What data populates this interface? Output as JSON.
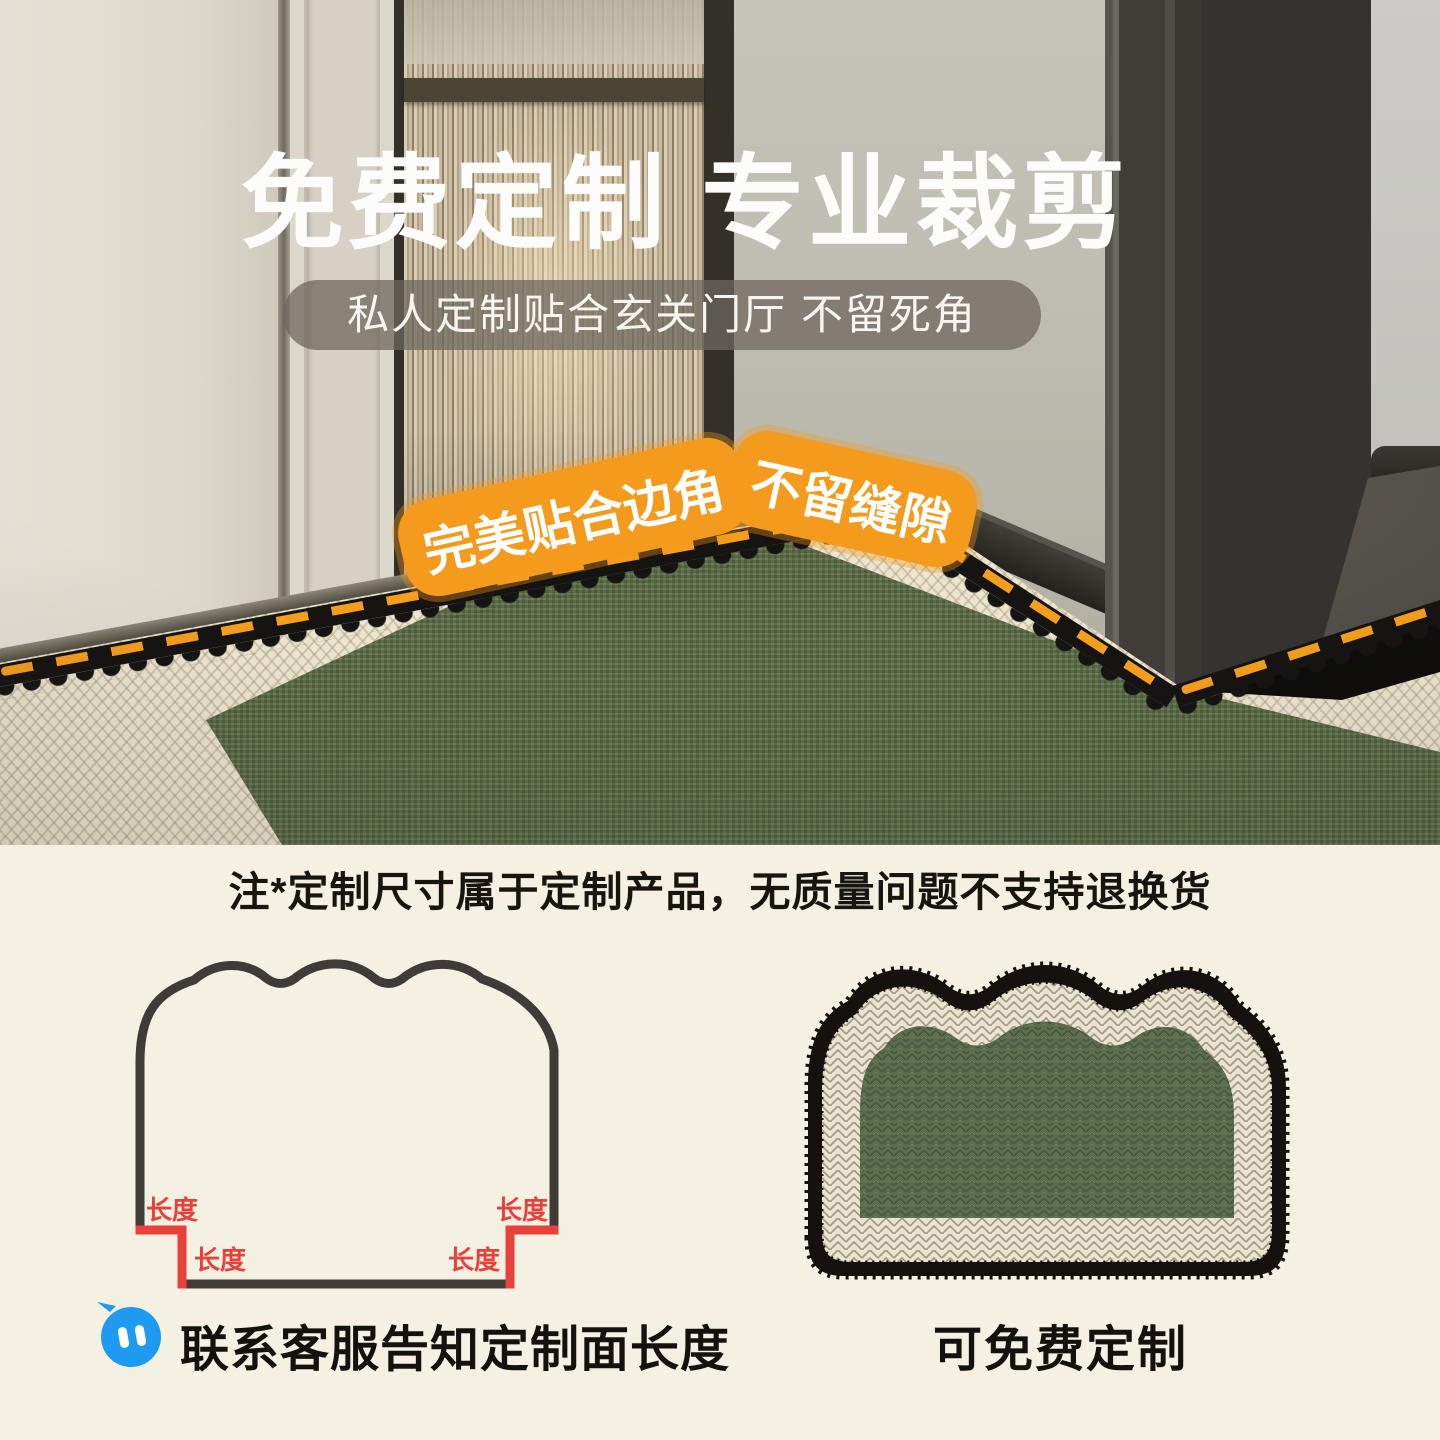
{
  "hero": {
    "title": "免费定制 专业裁剪",
    "subtitle": "私人定制贴合玄关门厅 不留死角",
    "badge_left": "完美贴合边角",
    "badge_right": "不留缝隙"
  },
  "notice": "注*定制尺寸属于定制产品，无质量问题不支持退换货",
  "diagram": {
    "length_label": "长度"
  },
  "footer": {
    "chat_icon": "customer-service-chat-icon",
    "contact_label": "联系客服告知定制面长度",
    "free_label": "可免费定制"
  },
  "colors": {
    "accent_orange": "#F49A1D",
    "accent_red": "#E8403A",
    "accent_blue": "#1E9BF0",
    "page_cream": "#F4F1E2",
    "rug_green": "#5C6E4A",
    "outline_dark": "#3F3C38"
  }
}
